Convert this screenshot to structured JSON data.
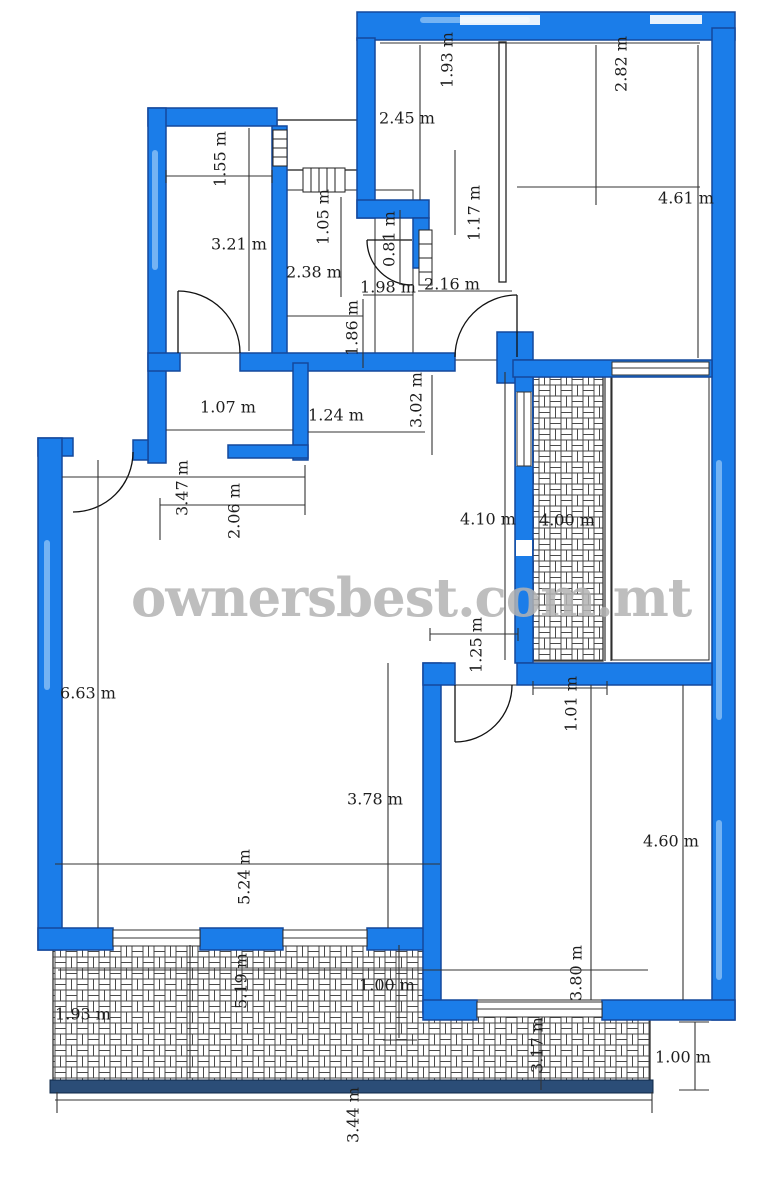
{
  "watermark": "ownersbest.com.mt",
  "unit": "m",
  "dims": [
    "1.93 m",
    "2.82 m",
    "2.45 m",
    "4.61 m",
    "1.55 m",
    "3.21 m",
    "1.05 m",
    "1.17 m",
    "0.81 m",
    "2.38 m",
    "1.98 m",
    "2.16 m",
    "1.86 m",
    "3.02 m",
    "1.07 m",
    "1.24 m",
    "3.47 m",
    "2.06 m",
    "4.10 m",
    "4.00 m",
    "1.25 m",
    "1.01 m",
    "6.63 m",
    "3.78 m",
    "4.60 m",
    "5.24 m",
    "3.80 m",
    "1.93 m",
    "5.19 m",
    "1.00 m",
    "3.17 m",
    "1.00 m",
    "3.44 m"
  ],
  "colors": {
    "wall_fill": "#1b7de9",
    "wall_edge": "#14489c",
    "navy_wall": "#2b4d77",
    "hatch_line": "#4a4a4a",
    "dim_text": "#1e1e1e",
    "watermark_gray": "#b3b3b3"
  }
}
